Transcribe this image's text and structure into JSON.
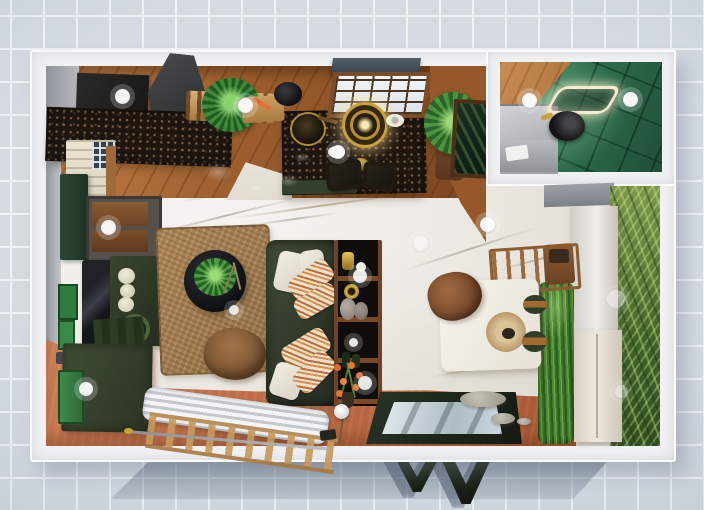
{
  "scene": {
    "type": "3d-floorplan-top-down-render",
    "rooms": [
      "kitchen",
      "living-room",
      "dining-area",
      "bathroom",
      "terrace-strip"
    ]
  },
  "palette": {
    "background": "#ccd3db",
    "grid_line": "#eef1f5",
    "wall_white": "#f2f3f5",
    "wood_floor": "#a4683a",
    "marble_floor": "#ebe7e0",
    "terracotta_floor": "#c1714b",
    "counter_dark": "#1d1510",
    "sofa_green": "#3a4431",
    "bathroom_tile_green": "#2e6b4f",
    "palm_wallpaper": "#5d7d3a",
    "grass_green": "#4e8a33",
    "accent_gold": "#c9a23c",
    "bright_door_green": "#3f8a4b",
    "shadow_blue": "rgba(99,112,132,0.55)"
  },
  "light_markers": [
    {
      "x": 122,
      "y": 96,
      "d": 15,
      "o": 0.95
    },
    {
      "x": 245,
      "y": 105,
      "d": 15,
      "o": 0.95
    },
    {
      "x": 338,
      "y": 152,
      "d": 14,
      "o": 0.9
    },
    {
      "x": 529,
      "y": 100,
      "d": 15,
      "o": 0.95
    },
    {
      "x": 630,
      "y": 99,
      "d": 15,
      "o": 0.95
    },
    {
      "x": 108,
      "y": 227,
      "d": 15,
      "o": 0.95
    },
    {
      "x": 487,
      "y": 224,
      "d": 15,
      "o": 0.95
    },
    {
      "x": 360,
      "y": 276,
      "d": 14,
      "o": 0.9
    },
    {
      "x": 365,
      "y": 383,
      "d": 14,
      "o": 0.9
    },
    {
      "x": 86,
      "y": 389,
      "d": 14,
      "o": 0.95
    },
    {
      "x": 234,
      "y": 310,
      "d": 10,
      "o": 0.85
    },
    {
      "x": 353,
      "y": 342,
      "d": 9,
      "o": 0.9
    },
    {
      "x": 616,
      "y": 299,
      "d": 18,
      "o": 0.45
    },
    {
      "x": 621,
      "y": 391,
      "d": 13,
      "o": 0.4
    },
    {
      "x": 420,
      "y": 243,
      "d": 15,
      "o": 0.45
    }
  ],
  "glints": [
    {
      "x": 218,
      "y": 172,
      "w": 30,
      "h": 18
    },
    {
      "x": 288,
      "y": 180,
      "w": 22,
      "h": 13
    },
    {
      "x": 256,
      "y": 188,
      "w": 16,
      "h": 10
    },
    {
      "x": 302,
      "y": 157,
      "w": 16,
      "h": 9
    }
  ],
  "stepping_stones": [
    {
      "x": 483,
      "y": 399,
      "w": 46,
      "h": 16
    },
    {
      "x": 503,
      "y": 418,
      "w": 24,
      "h": 11
    },
    {
      "x": 524,
      "y": 421,
      "w": 14,
      "h": 7
    }
  ],
  "objects": [
    "outer-walls",
    "kitchen-upper-cabinets",
    "range-hood",
    "kitchen-counter",
    "kitchen-island",
    "bar-stools",
    "pendant-lamp",
    "kitchen-window",
    "window-awning",
    "potted-plant",
    "palm-plant",
    "spice-shelf",
    "cutting-board",
    "cooking-pot",
    "wok-pan",
    "wall-picture",
    "bathroom",
    "bathroom-mirror-light",
    "bathroom-sink",
    "bathroom-vanity",
    "shower",
    "tv-screen",
    "media-console",
    "tall-green-cabinet",
    "green-sideboard",
    "decor-vases",
    "wall-window-shutter",
    "area-rug",
    "round-coffee-table",
    "table-plant",
    "floor-pouf",
    "corner-sofa",
    "throw-pillows",
    "shelving-unit",
    "flower-vase",
    "radiator-bench",
    "wood-ladder",
    "curtain-rod",
    "green-door",
    "lower-cabinet",
    "dining-table",
    "dining-centerpiece",
    "upholstered-chair",
    "wooden-chair",
    "wooden-stool",
    "low-stools",
    "grass-planter",
    "room-divider",
    "wardrobe",
    "palm-wallpaper-wall",
    "terrace-floor",
    "glass-top-table",
    "stepping-stones",
    "garden-ball-light",
    "open-door-leaves",
    "light-markers"
  ]
}
